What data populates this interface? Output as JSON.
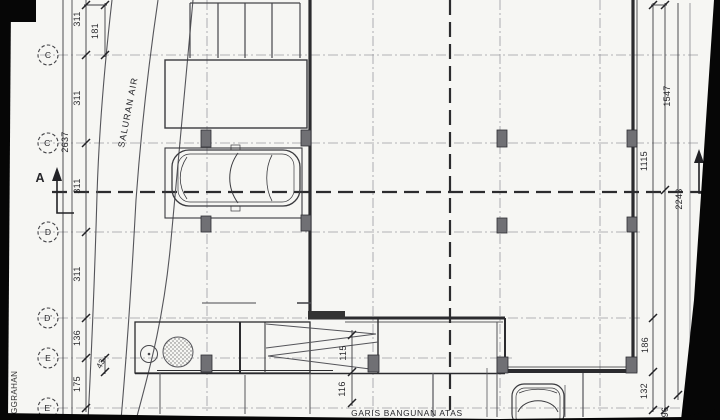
{
  "drawing": {
    "type": "site-plan-scan",
    "labels": {
      "saluran_air": "SALURAN AIR",
      "garis_bangunan_atas": "GARIS BANGUNAN ATAS",
      "left_margin": "GGRAHAN",
      "section_marker": "A"
    },
    "grid": [
      "C",
      "C'",
      "D",
      "D'",
      "E",
      "E'"
    ],
    "dimensions": {
      "left": [
        "311",
        "181",
        "311",
        "2637",
        "311",
        "311",
        "136",
        "43",
        "175"
      ],
      "right": [
        "1547",
        "1115",
        "2243",
        "186",
        "132",
        "96"
      ],
      "middle": [
        "115",
        "116"
      ]
    },
    "colors": {
      "paper": "#f6f6f3",
      "line": "#3c3c40",
      "wall": "#2b2b2e",
      "column_fill": "#707074",
      "scan_edge": "#060606",
      "grid_line": "#9a9aa0"
    }
  }
}
